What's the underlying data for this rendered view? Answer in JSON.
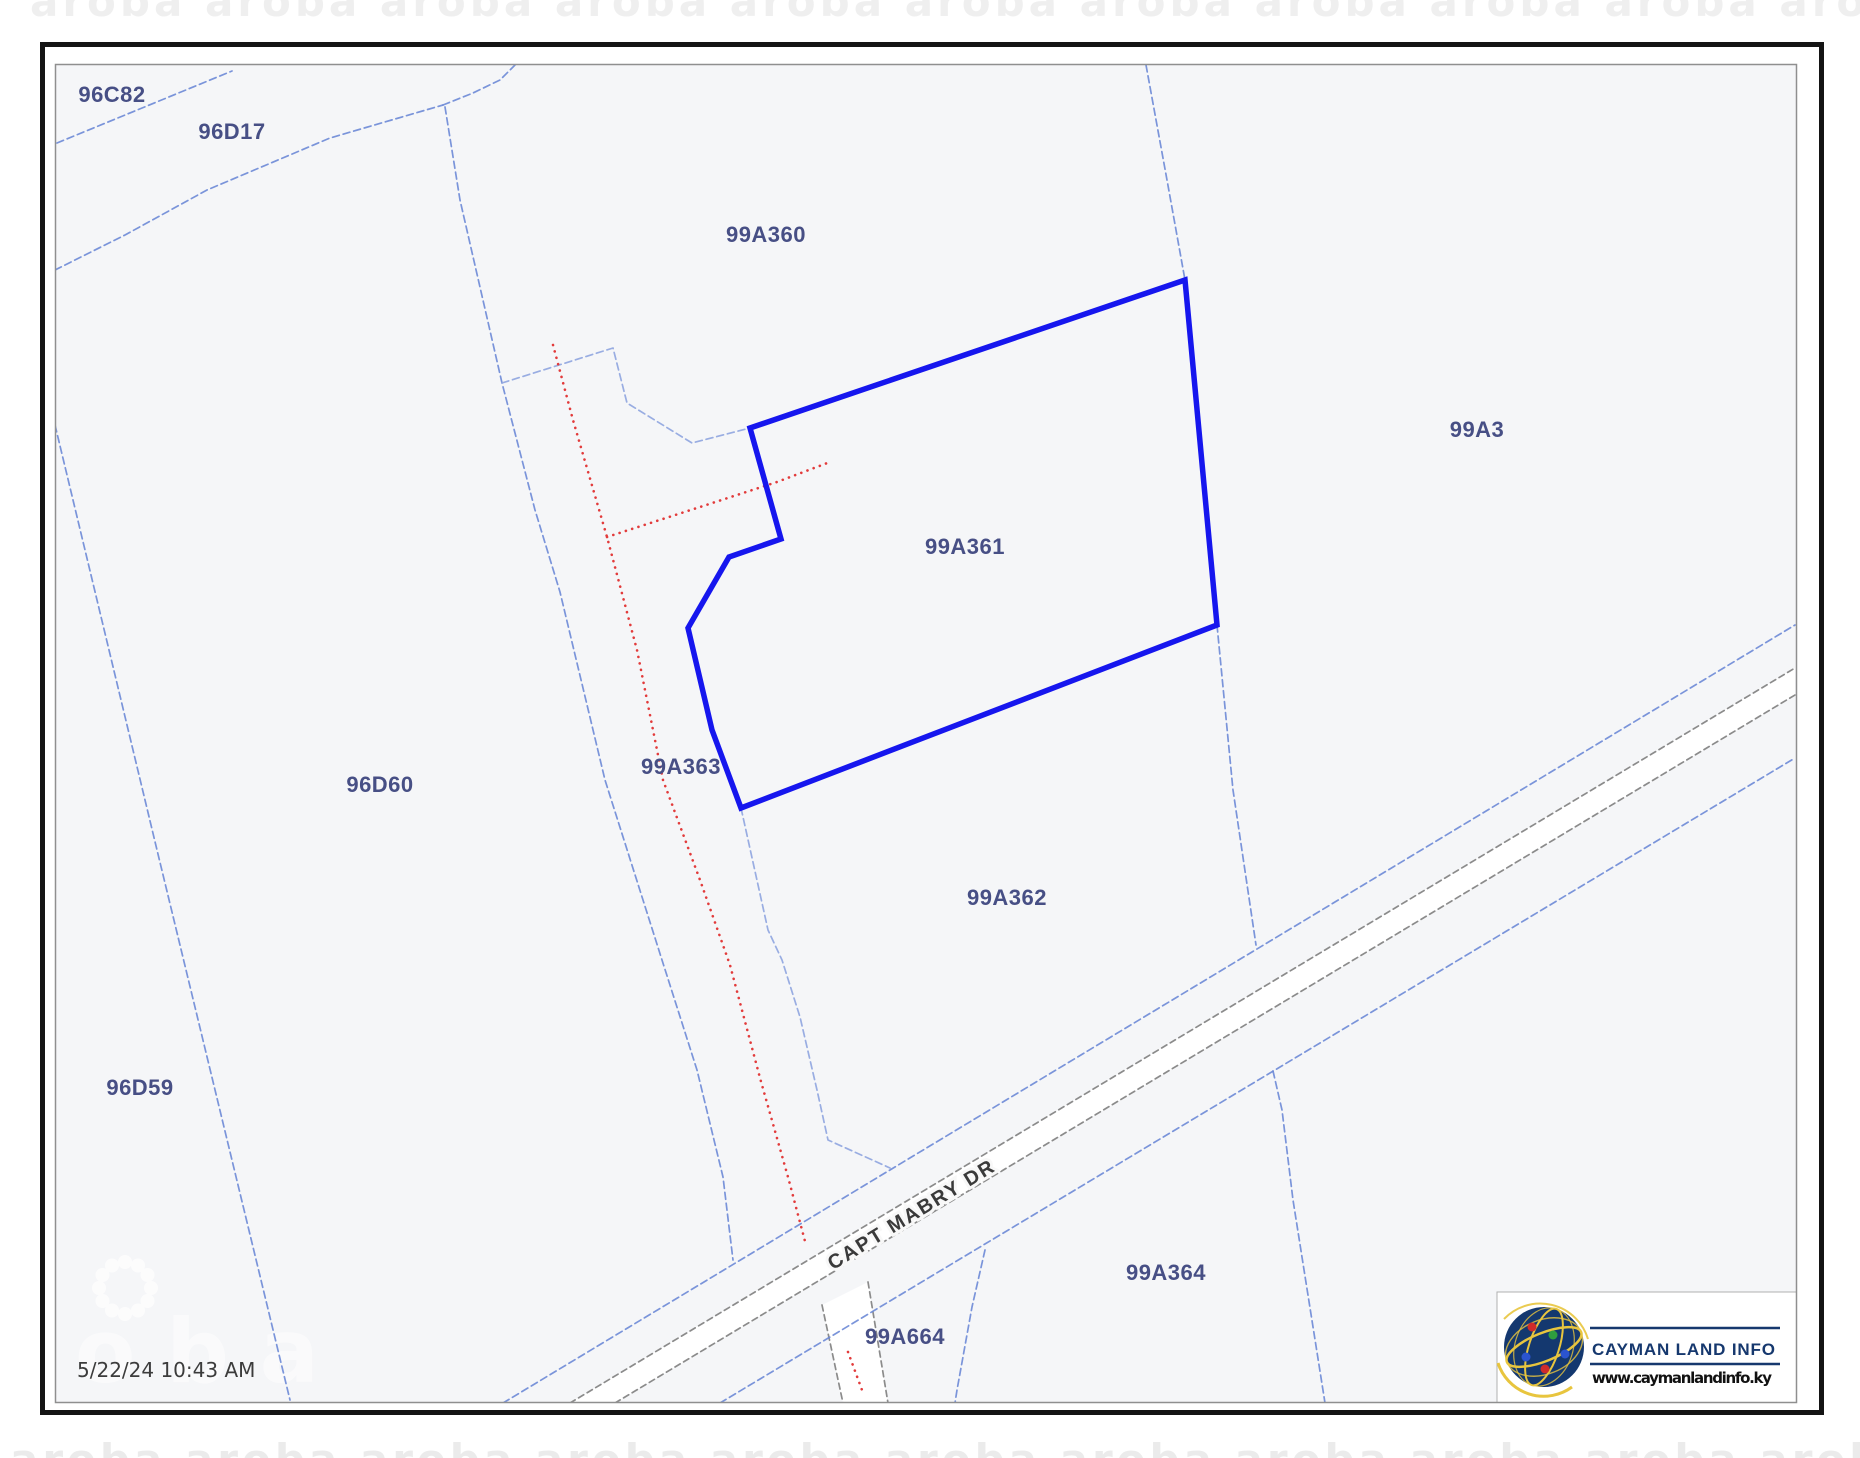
{
  "page": {
    "timestamp": "5/22/24 10:43 AM"
  },
  "map": {
    "background_color": "#f5f6f8",
    "boundary_color": "#6d89d6",
    "boundary_color_light": "#93a9e0",
    "selected_outline_color": "#1616ee",
    "road_edge_color": "#8b8b8b",
    "footpath_color": "#e23b3b",
    "label_color": "#474f85",
    "selected_parcel": "99A361",
    "road": {
      "name": "CAPT MABRY DR"
    },
    "parcels": [
      {
        "id": "96C82"
      },
      {
        "id": "96D17"
      },
      {
        "id": "99A360"
      },
      {
        "id": "99A3"
      },
      {
        "id": "99A361",
        "selected": true
      },
      {
        "id": "96D60"
      },
      {
        "id": "99A363"
      },
      {
        "id": "99A362"
      },
      {
        "id": "96D59"
      },
      {
        "id": "99A364"
      },
      {
        "id": "99A664"
      }
    ]
  },
  "logo": {
    "title": "CAYMAN LAND INFO",
    "website": "www.caymanlandinfo.ky"
  },
  "watermark": {
    "map_text": "oba",
    "strip_text": "aroba aroba aroba aroba aroba aroba aroba aroba aroba aroba aroba aroba aroba aroba aroba"
  }
}
